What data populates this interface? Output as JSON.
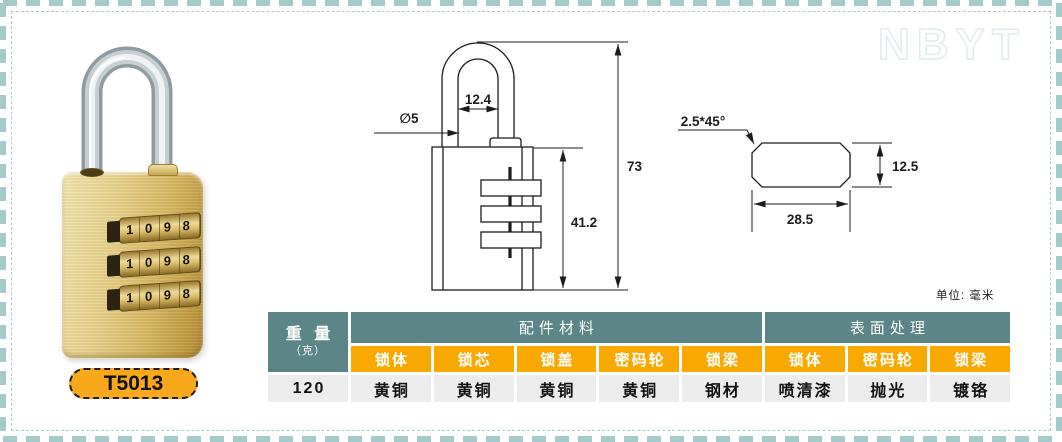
{
  "watermark": "NBYT",
  "units_note": "单位: 毫米",
  "product": {
    "model": "T5013",
    "dial_rows": [
      "1 0 9 8",
      "1 0 9 8",
      "1 0 9 8"
    ]
  },
  "drawing": {
    "front_view": {
      "shackle_inner_width": "12.4",
      "shackle_diameter": "∅5",
      "total_height": "73",
      "body_height": "41.2"
    },
    "side_view": {
      "chamfer": "2.5*45°",
      "body_width": "28.5",
      "body_depth": "12.5"
    }
  },
  "spec_table": {
    "weight_label": "重 量",
    "weight_unit": "（克）",
    "group_headers": [
      "配件材料",
      "表面处理"
    ],
    "material_columns": [
      "锁体",
      "锁芯",
      "锁盖",
      "密码轮",
      "锁梁"
    ],
    "surface_columns": [
      "锁体",
      "密码轮",
      "锁梁"
    ],
    "weight_value": "120",
    "material_values": [
      "黄铜",
      "黄铜",
      "黄铜",
      "黄铜",
      "钢材"
    ],
    "surface_values": [
      "喷清漆",
      "抛光",
      "镀铬"
    ]
  },
  "colors": {
    "header_teal": "#5B8587",
    "header_orange": "#F9A800",
    "data_row_bg": "#ECECEC",
    "badge_orange": "#F9A81C",
    "border_dash_teal": "#A4CACA",
    "brass": "#D6B763",
    "shackle_silver": "#C6CED2"
  }
}
